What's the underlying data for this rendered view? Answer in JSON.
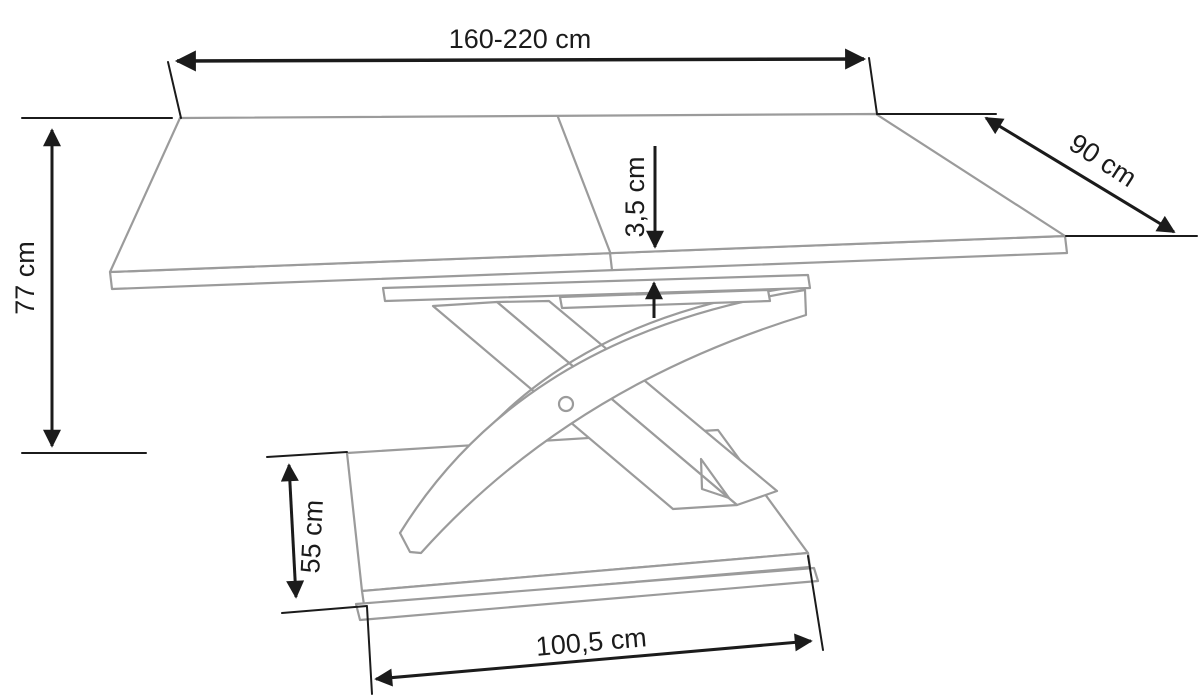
{
  "drawing": {
    "type": "furniture technical line drawing",
    "subject": "extendable rectangular table with X-shaped pedestal base on plinth",
    "background_color": "#ffffff",
    "outline_color": "#9b9b9b",
    "dimension_color": "#1b1b1b",
    "dimensions": [
      {
        "id": "table-length",
        "label": "160-220 cm"
      },
      {
        "id": "table-depth",
        "label": "90 cm"
      },
      {
        "id": "table-height",
        "label": "77 cm"
      },
      {
        "id": "top-thickness",
        "label": "3,5 cm"
      },
      {
        "id": "base-height",
        "label": "55 cm"
      },
      {
        "id": "base-width",
        "label": "100,5 cm"
      }
    ]
  }
}
